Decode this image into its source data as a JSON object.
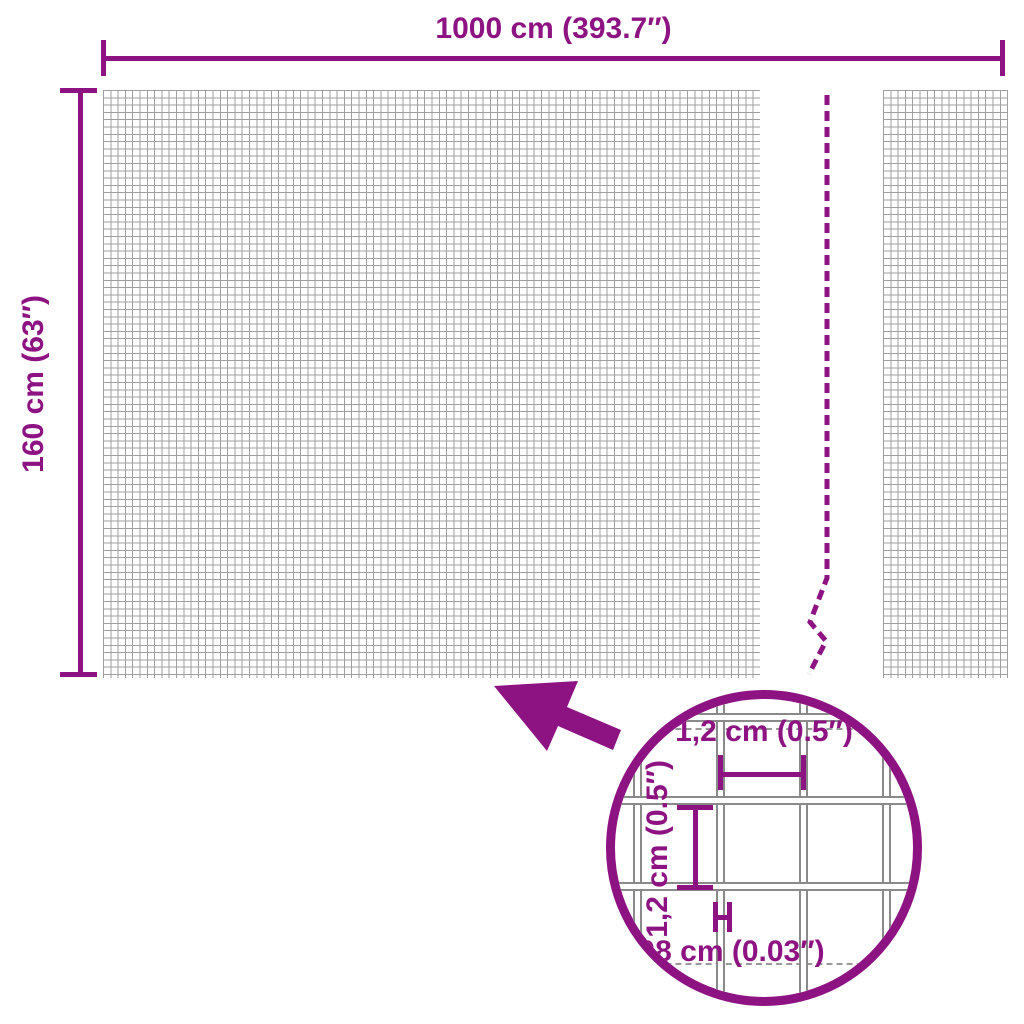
{
  "diagram": {
    "title_width": "1000 cm (393.7″)",
    "title_height": "160 cm (63″)",
    "detail": {
      "opening_width": "1,2 cm (0.5″)",
      "opening_height": "1,2 cm (0.5″)",
      "wire_thickness": "0,08 cm (0.03″)"
    },
    "colors": {
      "accent": "#8E1382",
      "mesh_line": "#9F9F9F",
      "wire_line": "#8A8A8A"
    }
  }
}
